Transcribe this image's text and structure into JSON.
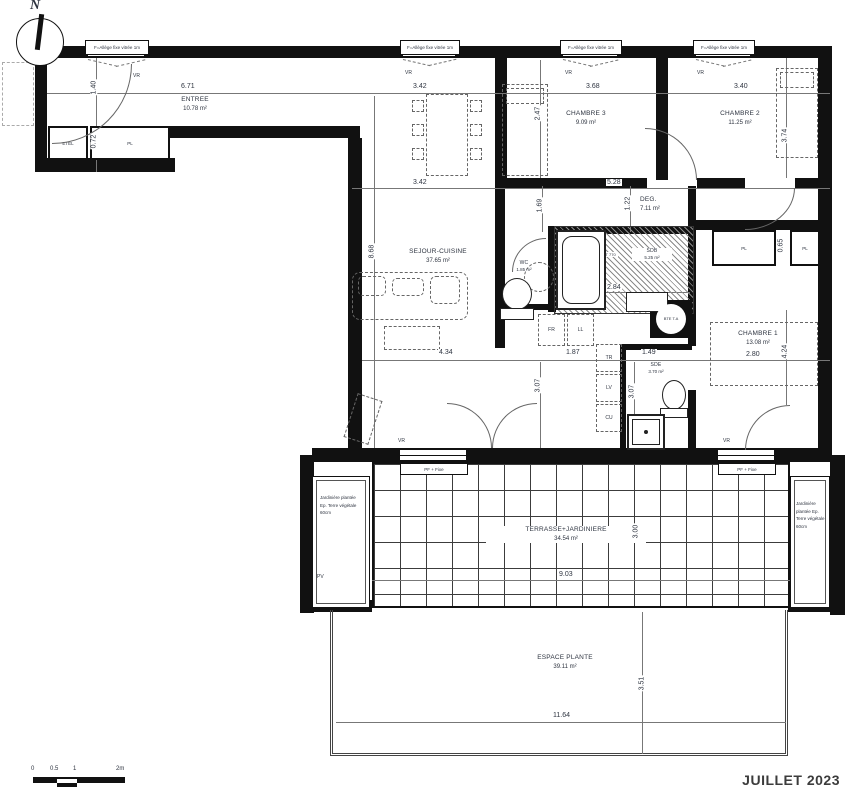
{
  "title": {
    "date": "JUILLET 2023"
  },
  "compass": {
    "n": "N"
  },
  "win": {
    "allege": "F=Allège fixe vitrée 1m",
    "vr": "VR",
    "pf": "PF + Fixe"
  },
  "rooms": {
    "entree": {
      "name": "ENTREE",
      "area": "10.78 m²"
    },
    "sejour": {
      "name": "SEJOUR-CUISINE",
      "area": "37.65 m²"
    },
    "chambre3": {
      "name": "CHAMBRE 3",
      "area": "9.09 m²"
    },
    "chambre2": {
      "name": "CHAMBRE 2",
      "area": "11.25 m²"
    },
    "chambre1": {
      "name": "CHAMBRE 1",
      "area": "13.08 m²"
    },
    "deg": {
      "name": "DEG.",
      "area": "7.11 m²"
    },
    "wc": {
      "name": "WC",
      "area": "1.85 m²"
    },
    "sdb": {
      "name": "SDB",
      "area": "5.25 m²"
    },
    "sde": {
      "name": "SDE",
      "area": "3.70 m²"
    },
    "terrasse": {
      "name": "TERRASSE+JARDINIERE",
      "area": "34.54 m²"
    },
    "espace": {
      "name": "ESPACE PLANTE",
      "area": "39.11 m²"
    }
  },
  "labels": {
    "pl": "PL",
    "etel": "ETEL",
    "fr": "FR",
    "ll": "LL",
    "tr": "TR",
    "lv": "LV",
    "cu": "CU",
    "pv": "PV",
    "bte": "BTE T.A",
    "rbt": "RBT 770",
    "planter": "Jardinière plantée Ep. Terre végétale 60cm"
  },
  "dims": {
    "d671": "6.71",
    "d140": "1.40",
    "d072": "0.72",
    "d342": "3.42",
    "d247": "2.47",
    "d368": "3.68",
    "d528": "5.28",
    "d340": "3.40",
    "d374": "3.74",
    "d169": "1.69",
    "d122": "1.22",
    "d868": "8.68",
    "d284": "2.84",
    "d434": "4.34",
    "d187": "1.87",
    "d149": "1.49",
    "d307": "3.07",
    "d280": "2.80",
    "d424": "4.24",
    "d065": "0.65",
    "d903": "9.03",
    "d300": "3.00",
    "d1164": "11.64",
    "d351": "3.51"
  },
  "scalebar": {
    "t0": "0",
    "t05": "0.5",
    "t1": "1",
    "t2": "2m"
  }
}
